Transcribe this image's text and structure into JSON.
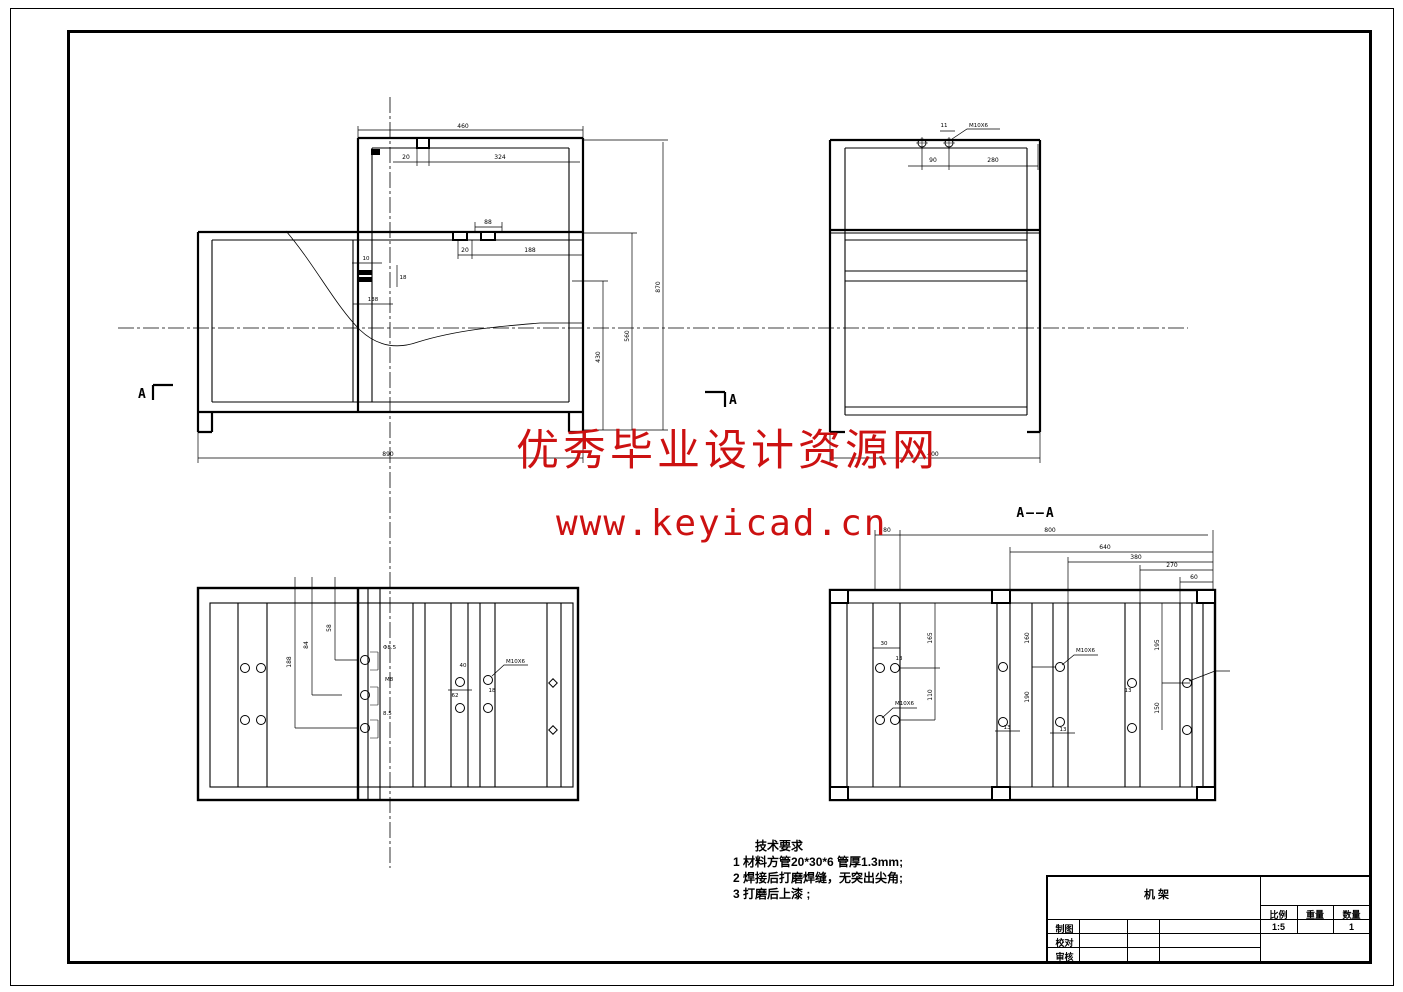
{
  "page": {
    "background": "#ffffff",
    "line_color": "#000000",
    "watermark_color": "#cc1111"
  },
  "watermark": {
    "line1": "优秀毕业设计资源网",
    "line2": "www.keyicad.cn"
  },
  "section_title": "A——A",
  "markers": {
    "left": "A",
    "right": "A"
  },
  "tech": {
    "title": "技术要求",
    "item1": "1 材料方管20*30*6 管厚1.3mm;",
    "item2": "2 焊接后打磨焊缝，无突出尖角;",
    "item3": "3 打磨后上漆 ;"
  },
  "title_block": {
    "part": "机架",
    "scale_label": "比例",
    "weight_label": "重量",
    "qty_label": "数量",
    "scale": "1:5",
    "weight": "",
    "qty": "1",
    "draw": "制图",
    "check": "校对",
    "audit": "审核"
  },
  "dims": {
    "front": {
      "top": "460",
      "d20a": "20",
      "d324": "324",
      "d88": "88",
      "d20b": "20",
      "d188": "188",
      "d10": "10",
      "d18": "18",
      "d138": "138",
      "h870": "870",
      "h560": "560",
      "h430": "430",
      "bottom": "890"
    },
    "side": {
      "d11": "11",
      "thread": "M10X6",
      "d90": "90",
      "d280": "280",
      "bottom": "400"
    },
    "plan": {
      "v58": "58",
      "v84": "84",
      "v188": "188",
      "c1": "Φ8.5",
      "c2": "M8",
      "c3": "8.5",
      "r40": "40",
      "r62": "62",
      "r18": "18",
      "thread": "M10X6"
    },
    "sect": {
      "w80": "80",
      "w800": "800",
      "w640": "640",
      "w380": "380",
      "w270": "270",
      "w60": "60",
      "h165": "165",
      "h110": "110",
      "h160": "160",
      "h190": "190",
      "h195": "195",
      "h150": "150",
      "s30": "30",
      "s13a": "13",
      "s13b": "13",
      "s13c": "13",
      "s13d": "13",
      "thread1": "M10X6",
      "thread2": "M10X6"
    }
  }
}
